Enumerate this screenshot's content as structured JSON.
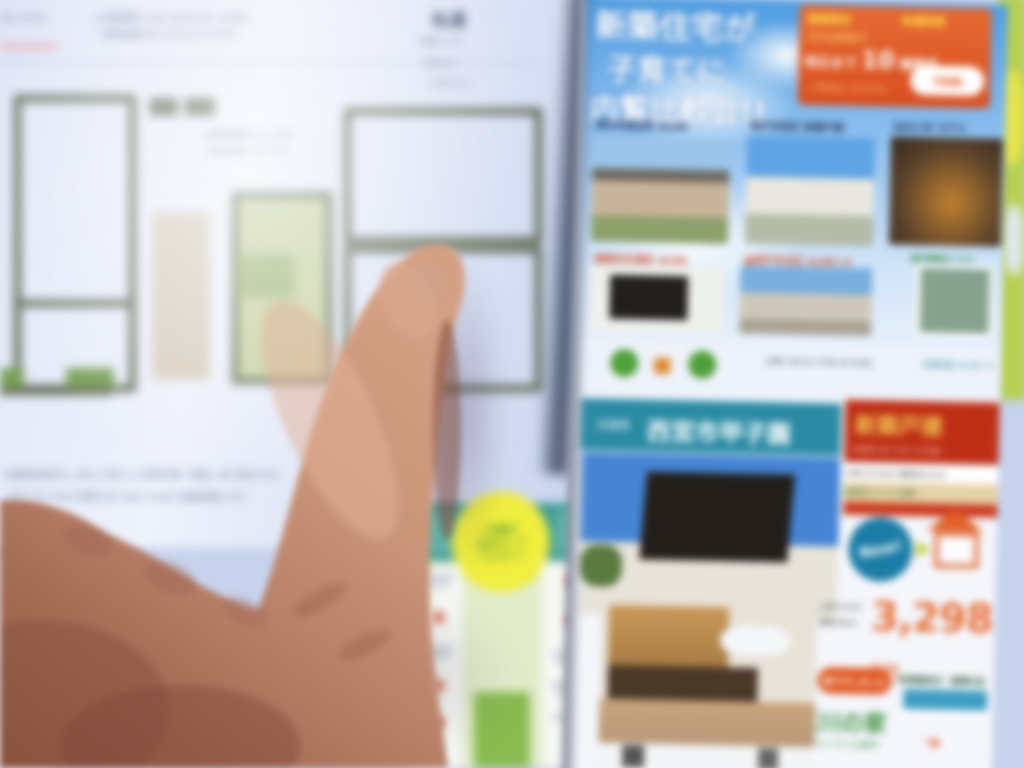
{
  "floorplan": {
    "corner_ref": "No.1034",
    "header_line1": "土地面積:120.00㎡(36.30坪)",
    "header_line2": "建物面積:98.00㎡(29.64坪)",
    "road_title": "私道",
    "road_line1": "幅員4.0m",
    "road_line2": "負担あり",
    "road_line3": "(持分1/5)",
    "center_note1": "1階床面積 51.34㎡",
    "center_note2": "2階床面積 46.37㎡",
    "footer_line1": "兵庫県西宮市○○町1丁目2-3 JR神戸線「西宮」駅 徒歩10分",
    "footer_line2": "土地:120.00㎡ 建物:98.00㎡ 4LDK 前面道路4.0m"
  },
  "sticker": {
    "line1": "ご来場で",
    "line2": "QUOカード",
    "line3": "プレゼント"
  },
  "flyer": {
    "headline1": "新築住宅が",
    "headline2": "子育てに",
    "headline3": "内覧比較会!!",
    "promo": {
      "top1": "期間限定",
      "top2": "来場特典",
      "row2": "見学会開催中",
      "big_prefix": "明日まで",
      "big_number": "10",
      "big_suffix": "棟限定",
      "small": "ご予約はこちらから",
      "oval": "予約制"
    },
    "row1_caption1": "明石市魚住町 4LDK",
    "row1_caption2": "神戸市西区 新築戸建",
    "row1_caption3": "加古川市 モデル",
    "row2_caption1": "姫路市広畑区 4LDK",
    "row2_caption2": "●神戸市北区 2LDK+S",
    "qr_caption": "物件情報はこちら",
    "company_note": "お問い合わせ 0798-00-0000",
    "company_note2": "営業時間 10:00〜18:00",
    "loc_prefix": "兵庫県",
    "loc_city": "西宮市甲子園",
    "banner_title": "新築戸建",
    "banner_sub": "4LDK+カースペース2台",
    "spec_line": "土地133.00㎡ 建物98.01㎡",
    "tan_line": "諸費用コミコミ価格",
    "badge": "New!",
    "price_note1": "土地:133㎡",
    "price_note2": "建物:98㎡",
    "price_amount": "3,298",
    "price_unit": "万円",
    "sold_label": "値下げしました",
    "feature": "全室南向き・駐車2台",
    "series": "石川の家",
    "series_sub": "モデルハウス公開中",
    "arrow_icon": "➜"
  },
  "colors": {
    "sky_blue": "#4f9de2",
    "promo_orange": "#e25a2a",
    "band_teal": "#2b8ba4",
    "banner_red": "#bf2f16",
    "price_orange": "#e8703a",
    "logo_green": "#4fa03a",
    "sticker_yellow": "#f0ee3e",
    "listing_teal": "#3e9a94",
    "wall_olive": "#5c6750",
    "skin": "#c08a72"
  }
}
